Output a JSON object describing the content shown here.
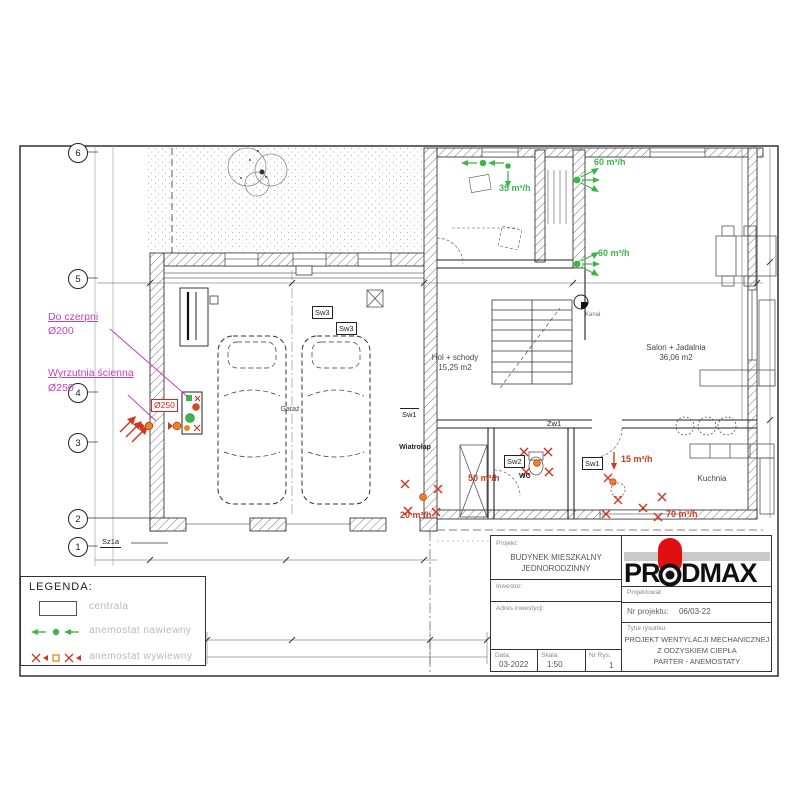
{
  "sheet": {
    "grid_labels": {
      "b6": "6",
      "b5": "5",
      "b4": "4",
      "b3": "3",
      "b2": "2",
      "b1": "1"
    }
  },
  "annotations": {
    "czerpnia_1": "Do czerpni",
    "czerpnia_2": "Ø200",
    "wyrzutnia_1": "Wyrzutnia ścienna",
    "wyrzutnia_2": "Ø250",
    "duct_250": "Ø250"
  },
  "flows": {
    "supply_hall_top": "60 m³/h",
    "supply_office": "35 m³/h",
    "supply_salon": "60 m³/h",
    "exhaust_wc": "50 m³/h",
    "exhaust_kitchen_hood": "15 m³/h",
    "exhaust_kitchen": "70 m³/h",
    "exhaust_vestibule": "20 m³/h"
  },
  "rooms": {
    "salon_name": "Salon + Jadalnia",
    "salon_area": "36,06 m2",
    "hall_name": "Hol + schody",
    "hall_area": "15,25 m2",
    "wc": "WC",
    "kitchen": "Kuchnia",
    "vestibule": "Wiatrołap",
    "garage": "Garaż",
    "duct_note": "Kanał"
  },
  "devices": {
    "sw3a": "Sw3",
    "sw3b": "Sw3",
    "sw2": "Sw2",
    "sw1": "Sw1",
    "zw1": "Zw1",
    "sz1a": "Sz1a",
    "sw1b": "Sw1"
  },
  "legend": {
    "title": "LEGENDA:",
    "centrala": "centrala",
    "supply": "anemostat nawiewny",
    "exhaust": "anemostat wywiewny"
  },
  "titleblock": {
    "project_label": "Projekt:",
    "project_line1": "BUDYNEK MIESZKALNY",
    "project_line2": "JEDNORODZINNY",
    "investor_label": "Inwestor:",
    "address_label": "Adres inwestycji:",
    "date_label": "Data:",
    "date_value": "03-2022",
    "scale_label": "Skala:",
    "scale_value": "1:50",
    "sheet_no_label": "Nr Rys.",
    "sheet_no_value": "1",
    "designer_label": "Projektował:",
    "project_no_label": "Nr projektu:",
    "project_no_value": "06/03-22",
    "drawing_title_label": "Tytuł rysunku:",
    "title_line1": "PROJEKT WENTYLACJI MECHANICZNEJ",
    "title_line2": "Z ODZYSKIEM CIEPŁA",
    "title_line3": "PARTER - ANEMOSTATY",
    "logo_left": "PR",
    "logo_right": "DMAX"
  },
  "colors": {
    "supply_green": "#3cb54a",
    "exhaust_red": "#cc3a22",
    "annotation_magenta": "#c43fc4",
    "logo_red": "#e01010"
  }
}
